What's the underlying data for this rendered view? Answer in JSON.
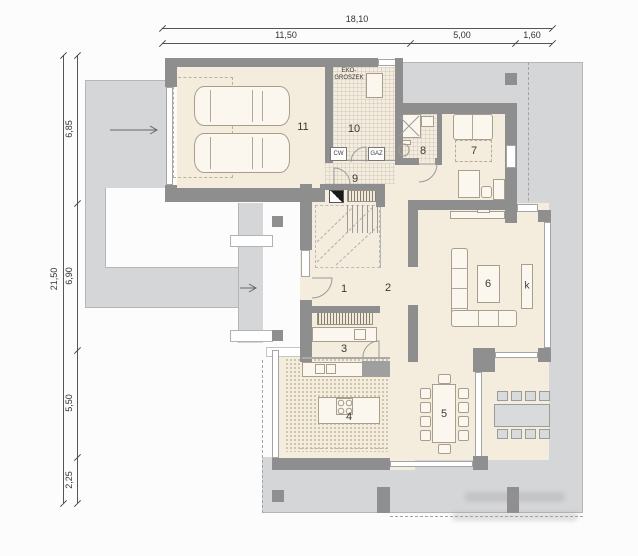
{
  "dimensions": {
    "top": {
      "overall": "18,10",
      "segments": [
        "11,50",
        "5,00",
        "1,60"
      ]
    },
    "left": {
      "overall": "21,50",
      "segments": [
        "6,85",
        "6,90",
        "5,50",
        "2,25"
      ]
    }
  },
  "rooms": {
    "r1": "1",
    "r2": "2",
    "r3": "3",
    "r4": "4",
    "r5": "5",
    "r6": "6",
    "r7": "7",
    "r8": "8",
    "r9": "9",
    "r10": "10",
    "r11": "11",
    "fireplace": "k"
  },
  "labels": {
    "fuel": "EKO-GROSZEK",
    "hot_water": "CW",
    "gas": "GAZ"
  },
  "colors": {
    "wall": "#8e8e8e",
    "paving": "#d5d6d8",
    "floor": "#f4ecdd"
  }
}
